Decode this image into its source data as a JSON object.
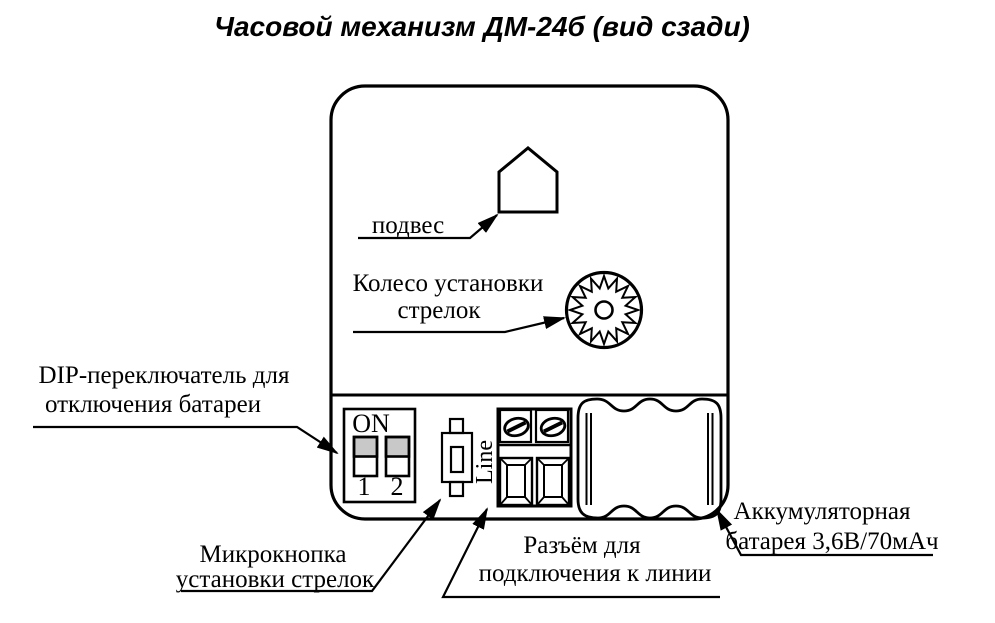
{
  "title": "Часовой механизм ДМ-24б (вид сзади)",
  "callouts": {
    "hanger": {
      "label": "подвес"
    },
    "hands_wheel": {
      "line1": "Колесо установки",
      "line2": "стрелок"
    },
    "dip_switch": {
      "line1": "DIP-переключатель для",
      "line2": "отключения батареи"
    },
    "microbutton": {
      "line1": "Микрокнопка",
      "line2": "установки стрелок"
    },
    "line_connector": {
      "line1": "Разъём для",
      "line2": "подключения к линии"
    },
    "battery": {
      "line1": "Аккумуляторная",
      "line2": "батарея 3,6В/70мАч"
    }
  },
  "device_markings": {
    "dip_on": "ON",
    "dip_pos_1": "1",
    "dip_pos_2": "2",
    "line_terminal": "Line"
  },
  "colors": {
    "ink": "#000000",
    "paper": "#ffffff",
    "dip_knob_gray": "#c8c8c8"
  }
}
